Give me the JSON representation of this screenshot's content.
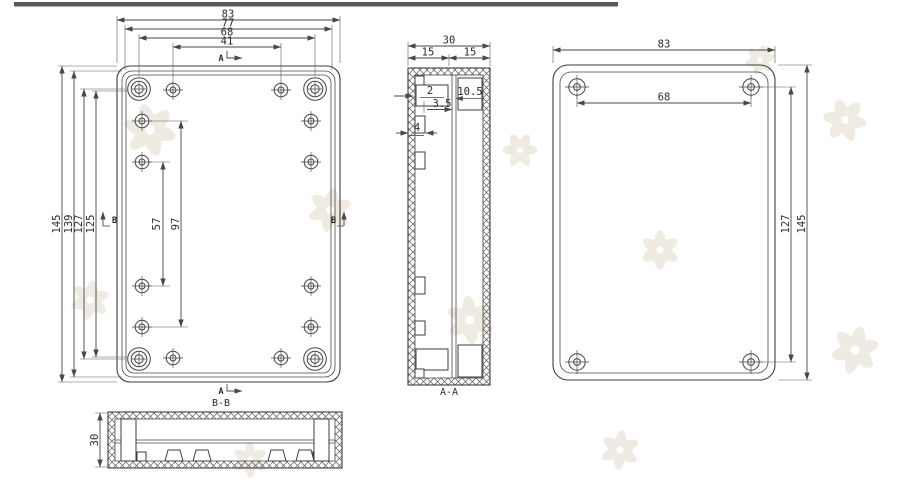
{
  "front_view": {
    "dims": {
      "width_outer": "83",
      "width_lip": "77",
      "width_boss_span": "68",
      "width_top_hole_span": "41",
      "height_outer": "145",
      "height_lip": "139",
      "height_boss_span": "127",
      "height_inner": "125",
      "side_hole_span_inner": "57",
      "side_hole_span_outer": "97"
    },
    "markers": {
      "section_a": "A",
      "section_b": "B"
    }
  },
  "section_aa": {
    "title": "A-A",
    "dims": {
      "depth_total": "30",
      "depth_left_half": "15",
      "depth_right_half": "15",
      "wall_thickness": "2",
      "lip_depth": "3.5",
      "pocket_depth": "10.5",
      "rib_width": "4"
    }
  },
  "back_view": {
    "dims": {
      "width_outer": "83",
      "hole_span_horizontal": "68",
      "hole_span_vertical": "127",
      "height_outer": "145"
    }
  },
  "section_bb": {
    "title": "B-B",
    "dims": {
      "depth_total": "30"
    }
  }
}
